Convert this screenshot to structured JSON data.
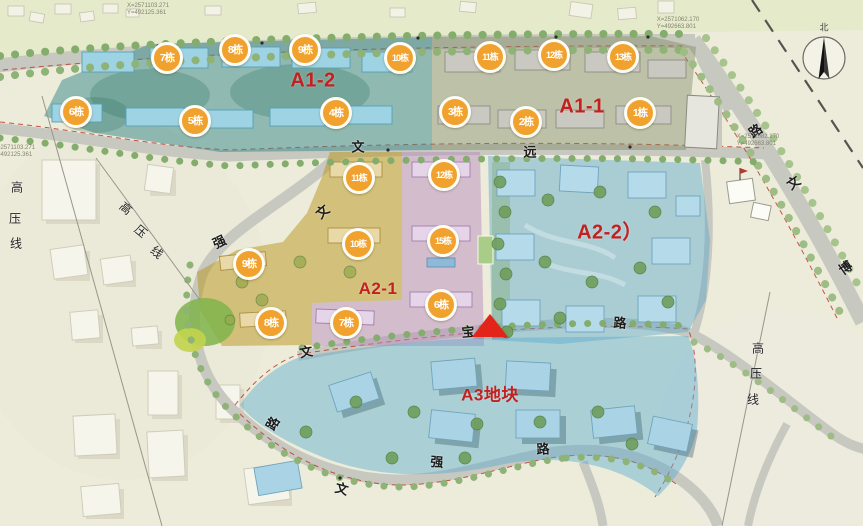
{
  "compass": {
    "north_label": "北"
  },
  "zones": [
    {
      "name": "zone-label-a1-2",
      "label": "A1-2",
      "x": 313,
      "y": 81,
      "fs": 20
    },
    {
      "name": "zone-label-a1-1",
      "label": "A1-1",
      "x": 582,
      "y": 107,
      "fs": 20
    },
    {
      "name": "zone-label-a2-1",
      "label": "A2-1",
      "x": 378,
      "y": 289,
      "fs": 17
    },
    {
      "name": "zone-label-a2-2",
      "label": "A2-2）",
      "x": 610,
      "y": 230,
      "fs": 20
    },
    {
      "name": "zone-label-a3",
      "label": "A3地块",
      "x": 490,
      "y": 393,
      "fs": 17
    }
  ],
  "buildings": [
    {
      "label": "7栋",
      "x": 167,
      "y": 58,
      "zone": "A1-2"
    },
    {
      "label": "8栋",
      "x": 235,
      "y": 50,
      "zone": "A1-2"
    },
    {
      "label": "9栋",
      "x": 305,
      "y": 50,
      "zone": "A1-2"
    },
    {
      "label": "10栋",
      "x": 400,
      "y": 58,
      "zone": "A1-2"
    },
    {
      "label": "6栋",
      "x": 76,
      "y": 112,
      "zone": "A1-2"
    },
    {
      "label": "5栋",
      "x": 195,
      "y": 121,
      "zone": "A1-2"
    },
    {
      "label": "4栋",
      "x": 336,
      "y": 113,
      "zone": "A1-2"
    },
    {
      "label": "11栋",
      "x": 490,
      "y": 57,
      "zone": "A1-1"
    },
    {
      "label": "12栋",
      "x": 554,
      "y": 55,
      "zone": "A1-1"
    },
    {
      "label": "13栋",
      "x": 623,
      "y": 57,
      "zone": "A1-1"
    },
    {
      "label": "3栋",
      "x": 455,
      "y": 112,
      "zone": "A1-1"
    },
    {
      "label": "2栋",
      "x": 526,
      "y": 122,
      "zone": "A1-1"
    },
    {
      "label": "1栋",
      "x": 640,
      "y": 113,
      "zone": "A1-1"
    },
    {
      "label": "11栋",
      "x": 359,
      "y": 178,
      "zone": "A2-1"
    },
    {
      "label": "12栋",
      "x": 444,
      "y": 175,
      "zone": "A2-1"
    },
    {
      "label": "10栋",
      "x": 358,
      "y": 244,
      "zone": "A2-1"
    },
    {
      "label": "15栋",
      "x": 443,
      "y": 241,
      "zone": "A2-1"
    },
    {
      "label": "9栋",
      "x": 249,
      "y": 264,
      "zone": "A2-1"
    },
    {
      "label": "8栋",
      "x": 271,
      "y": 323,
      "zone": "A2-1"
    },
    {
      "label": "7栋",
      "x": 346,
      "y": 323,
      "zone": "A2-1"
    },
    {
      "label": "6栋",
      "x": 441,
      "y": 305,
      "zone": "A2-1"
    }
  ],
  "road_labels": [
    {
      "label": "文",
      "x": 358,
      "y": 146,
      "rot": 0
    },
    {
      "label": "远",
      "x": 530,
      "y": 151,
      "rot": 0
    },
    {
      "label": "文",
      "x": 322,
      "y": 211,
      "rot": -40
    },
    {
      "label": "强",
      "x": 219,
      "y": 241,
      "rot": -25
    },
    {
      "label": "路",
      "x": 272,
      "y": 423,
      "rot": -60
    },
    {
      "label": "文",
      "x": 306,
      "y": 351,
      "rot": -10
    },
    {
      "label": "宝",
      "x": 468,
      "y": 331,
      "rot": -5
    },
    {
      "label": "路",
      "x": 620,
      "y": 322,
      "rot": 3
    },
    {
      "label": "文",
      "x": 342,
      "y": 488,
      "rot": 15
    },
    {
      "label": "强",
      "x": 437,
      "y": 461,
      "rot": 5
    },
    {
      "label": "路",
      "x": 543,
      "y": 448,
      "rot": -3
    },
    {
      "label": "路",
      "x": 755,
      "y": 130,
      "rot": -35
    },
    {
      "label": "文",
      "x": 793,
      "y": 182,
      "rot": -35
    },
    {
      "label": "博",
      "x": 845,
      "y": 267,
      "rot": -35
    }
  ],
  "powerline_labels": [
    {
      "label": "高",
      "x": 17,
      "y": 187,
      "rot": 0
    },
    {
      "label": "压",
      "x": 15,
      "y": 218,
      "rot": 0
    },
    {
      "label": "线",
      "x": 16,
      "y": 243,
      "rot": 0
    },
    {
      "label": "高",
      "x": 126,
      "y": 208,
      "rot": 40
    },
    {
      "label": "压",
      "x": 141,
      "y": 231,
      "rot": 40
    },
    {
      "label": "线",
      "x": 157,
      "y": 252,
      "rot": 40
    },
    {
      "label": "高",
      "x": 758,
      "y": 348,
      "rot": 0
    },
    {
      "label": "压",
      "x": 756,
      "y": 373,
      "rot": 0
    },
    {
      "label": "线",
      "x": 753,
      "y": 399,
      "rot": 0
    }
  ],
  "survey_annotations": [
    {
      "label": "X=2571103.271\nY=492125.361",
      "x": 148,
      "y": 10
    },
    {
      "label": "X=2571103.271\nY=492125.361",
      "x": 14,
      "y": 152
    },
    {
      "label": "X=2571062.170\nY=492663.801",
      "x": 678,
      "y": 24
    },
    {
      "label": "X=2571082.170\nY=492663.801",
      "x": 758,
      "y": 141
    }
  ],
  "marker": {
    "type": "location-triangle",
    "x": 490,
    "y": 315,
    "color": "#e3241b"
  },
  "colors": {
    "badge_orange": "#f1a22e",
    "zone_label_red": "#c32020",
    "a1_2_overlay_teal": "#3a8a8a",
    "a1_1_overlay_olive": "#7d8560",
    "a2_1_gold": "#ba941a",
    "a2_1_pink": "#b68abc",
    "a2_2_blue": "#58a8cd",
    "a3_blue": "#5cacd0",
    "marker_red": "#e3241b"
  }
}
